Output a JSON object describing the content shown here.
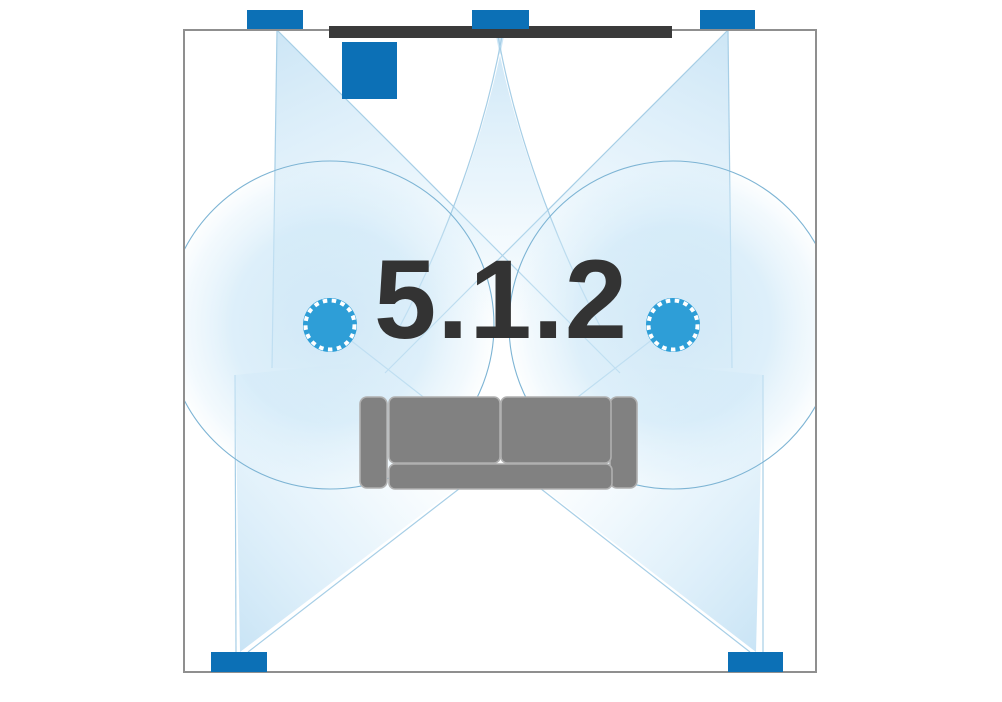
{
  "diagram": {
    "title_label": "5.1.2",
    "type": "surround-sound speaker layout, top-down room view",
    "room": {
      "x": 184,
      "y": 30,
      "width": 632,
      "height": 642,
      "border_color": "#8f8f8f",
      "floor_color": "#ffffff"
    },
    "tv": {
      "name": "tv-screen",
      "color": "#3a3a3a"
    },
    "speakers": [
      {
        "name": "front-left-speaker",
        "kind": "wall",
        "color": "#0c70b6"
      },
      {
        "name": "center-speaker",
        "kind": "wall",
        "color": "#0c70b6"
      },
      {
        "name": "front-right-speaker",
        "kind": "wall",
        "color": "#0c70b6"
      },
      {
        "name": "subwoofer",
        "kind": "box",
        "color": "#0c70b6"
      },
      {
        "name": "surround-left-speaker",
        "kind": "wall",
        "color": "#0c70b6"
      },
      {
        "name": "surround-right-speaker",
        "kind": "wall",
        "color": "#0c70b6"
      },
      {
        "name": "ceiling-left-speaker",
        "kind": "ceiling-dot",
        "color": "#2e9ed7"
      },
      {
        "name": "ceiling-right-speaker",
        "kind": "ceiling-dot",
        "color": "#2e9ed7"
      }
    ],
    "sofa": {
      "name": "sofa",
      "color": "#818181",
      "outline": "#b0b0b0"
    },
    "sound_fields": {
      "cone_fill": "#cfe6f5",
      "cone_edge": "#a6cee6",
      "ceiling_circle_fill": "#cde6f6",
      "ceiling_circle_edge": "#7db4d4"
    },
    "label_color": "#333333"
  }
}
